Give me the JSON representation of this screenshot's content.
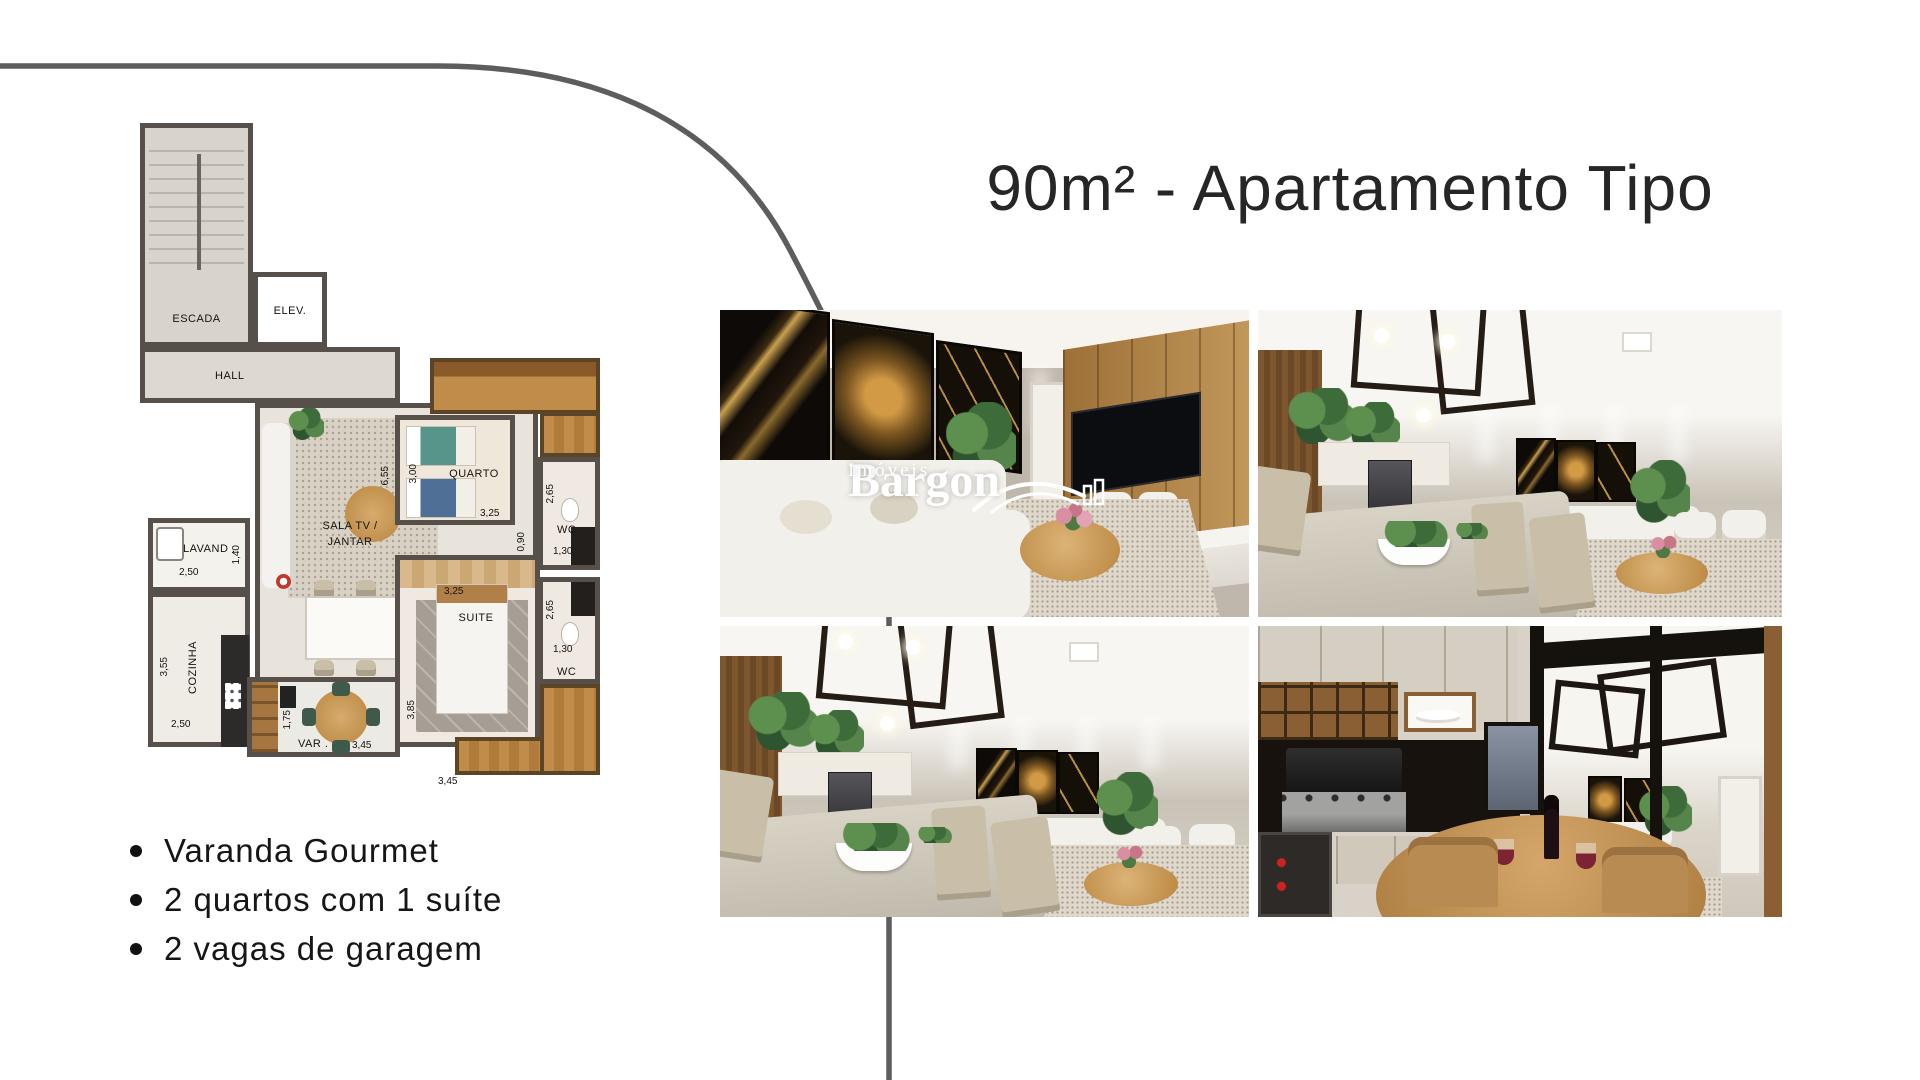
{
  "title": "90m² - Apartamento Tipo",
  "features": [
    "Varanda Gourmet",
    "2 quartos com 1 suíte",
    "2 vagas de garagem"
  ],
  "watermark": {
    "brand": "Bargon",
    "subtitle": "Imóveis"
  },
  "floor_plan": {
    "labels": {
      "escada": "ESCADA",
      "elev": "ELEV.",
      "hall": "HALL",
      "quarto": "QUARTO",
      "sala_line1": "SALA TV /",
      "sala_line2": "JANTAR",
      "lavand": "LAVAND .",
      "cozinha": "COZINHA",
      "suite": "SUITE",
      "varanda": "VAR .",
      "wc_top": "WC",
      "wc_bottom": "WC"
    },
    "dimensions": {
      "sala_height": "6,55",
      "quarto_width": "3,00",
      "quarto_length": "3,25",
      "wc_top_height": "2,65",
      "wc_top_width": "1,30",
      "corridor": "0,90",
      "wc_bottom_height": "2,65",
      "wc_bottom_width": "1,30",
      "lavand_width": "2,50",
      "lavand_height": "1,40",
      "cozinha_height": "3,55",
      "cozinha_width": "2,50",
      "dining_width": "3,45",
      "suite_width": "3,25",
      "suite_height": "3,85",
      "varanda_height": "1,75",
      "varanda_width": "3,45"
    }
  },
  "photos": [
    {
      "name": "living-room-tv-wall"
    },
    {
      "name": "dining-and-living-room"
    },
    {
      "name": "dining-and-living-room-alt"
    },
    {
      "name": "varanda-gourmet"
    }
  ],
  "colors": {
    "accent_line": "#5d5d5d",
    "title_text": "#262626",
    "plan_wall": "#57504a",
    "plan_wood": "#c08c49",
    "watermark": "#ffffff"
  }
}
